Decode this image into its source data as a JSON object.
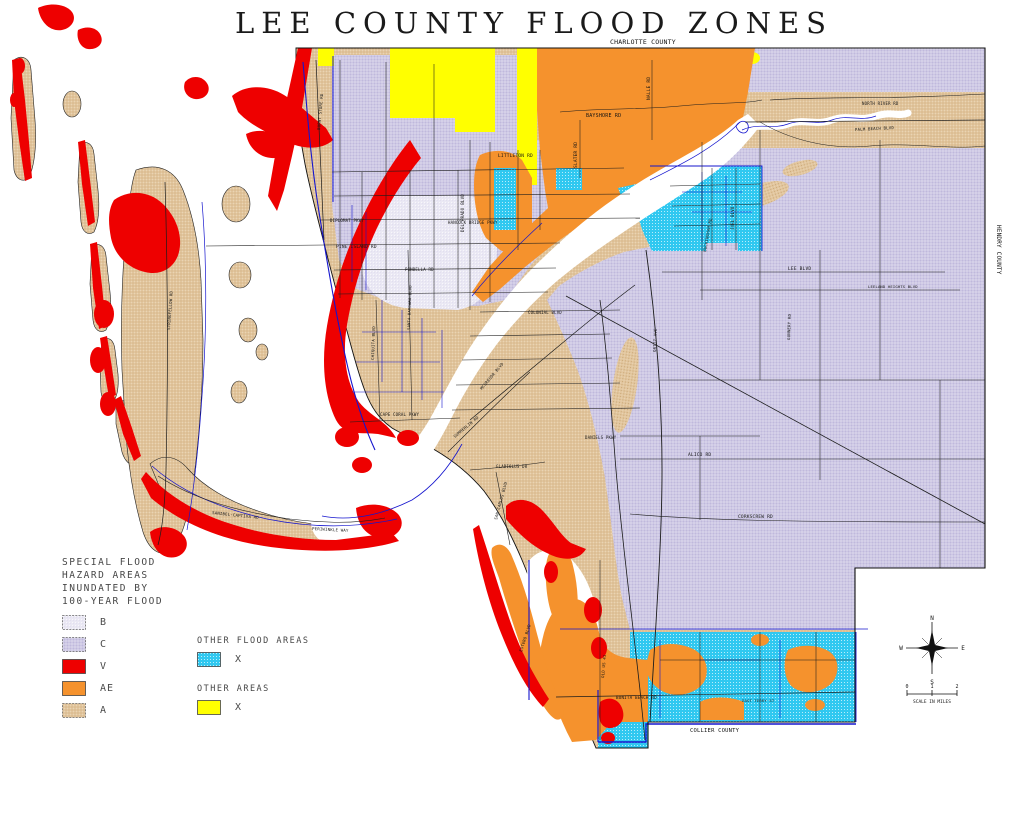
{
  "title": "LEE COUNTY FLOOD ZONES",
  "colors": {
    "zone_b": "#EAE8F4",
    "zone_c": "#CBC6E3",
    "zone_v": "#EE0000",
    "zone_ae": "#F5922D",
    "zone_a": "#E2C69E",
    "zone_x_flood": "#30C8F0",
    "zone_x_other": "#FFFF00",
    "water": "#FFFFFF",
    "canal_blue": "#1515CE",
    "road_black": "#1C1C1C"
  },
  "legend": {
    "title": "SPECIAL FLOOD\nHAZARD AREAS\nINUNDATED BY\n100-YEAR FLOOD",
    "items": [
      {
        "label": "B"
      },
      {
        "label": "C"
      },
      {
        "label": "V"
      },
      {
        "label": "AE"
      },
      {
        "label": "A"
      }
    ],
    "other_flood": {
      "title": "OTHER FLOOD AREAS",
      "item_label": "X"
    },
    "other": {
      "title": "OTHER AREAS",
      "item_label": "X"
    }
  },
  "compass": {
    "n": "N",
    "s": "S",
    "e": "E",
    "w": "W"
  },
  "scale_bar": {
    "ticks": [
      "0",
      "1",
      "2"
    ],
    "label": "SCALE IN MILES"
  },
  "map": {
    "labels": [
      {
        "text": "CHARLOTTE COUNTY",
        "x": 610,
        "y": 44,
        "size": 6.5
      },
      {
        "text": "HENDRY COUNTY",
        "x": 997,
        "y": 225,
        "size": 6,
        "rot": 90
      },
      {
        "text": "COLLIER COUNTY",
        "x": 690,
        "y": 732,
        "size": 5.5
      },
      {
        "text": "BAYSHORE RD",
        "x": 586,
        "y": 117,
        "size": 5
      },
      {
        "text": "SLATER RD",
        "x": 577,
        "y": 168,
        "size": 4.5,
        "rot": -90
      },
      {
        "text": "NALLE RD",
        "x": 650,
        "y": 100,
        "size": 4.5,
        "rot": -90
      },
      {
        "text": "DEL PRADO BLVD",
        "x": 464,
        "y": 232,
        "size": 4.2,
        "rot": -90
      },
      {
        "text": "LITTLETON RD",
        "x": 498,
        "y": 157,
        "size": 4.5
      },
      {
        "text": "HANCOCK BRIDGE PKWY",
        "x": 448,
        "y": 224,
        "size": 4
      },
      {
        "text": "DIPLOMAT PKWY",
        "x": 330,
        "y": 222,
        "size": 4
      },
      {
        "text": "PINE ISLAND RD",
        "x": 336,
        "y": 248,
        "size": 4.5
      },
      {
        "text": "PONDELLA RD",
        "x": 405,
        "y": 271,
        "size": 4
      },
      {
        "text": "COLONIAL BLVD",
        "x": 528,
        "y": 314,
        "size": 4
      },
      {
        "text": "DANIELS PKWY",
        "x": 585,
        "y": 439,
        "size": 4
      },
      {
        "text": "PALM BEACH BLVD",
        "x": 855,
        "y": 131,
        "size": 4,
        "rot": -3
      },
      {
        "text": "NORTH RIVER RD",
        "x": 862,
        "y": 105,
        "size": 4
      },
      {
        "text": "ALICO RD",
        "x": 688,
        "y": 456,
        "size": 4.5
      },
      {
        "text": "CORKSCREW RD",
        "x": 738,
        "y": 518,
        "size": 4.5
      },
      {
        "text": "LEE BLVD",
        "x": 788,
        "y": 270,
        "size": 4.5
      },
      {
        "text": "LEELAND HEIGHTS BLVD",
        "x": 868,
        "y": 288,
        "size": 3.8
      },
      {
        "text": "JOEL BLVD",
        "x": 734,
        "y": 230,
        "size": 4,
        "rot": -90
      },
      {
        "text": "GUNNERY RD",
        "x": 790,
        "y": 340,
        "size": 4,
        "rot": -88
      },
      {
        "text": "BUCKINGHAM RD",
        "x": 706,
        "y": 252,
        "size": 4,
        "rot": -80
      },
      {
        "text": "BONITA BEACH RD",
        "x": 616,
        "y": 699,
        "size": 4.2
      },
      {
        "text": "OLD US 41",
        "x": 604,
        "y": 678,
        "size": 4,
        "rot": -85
      },
      {
        "text": "EAST TERRY ST",
        "x": 742,
        "y": 702,
        "size": 3.8
      },
      {
        "text": "STRINGFELLOW RD",
        "x": 170,
        "y": 330,
        "size": 4,
        "rot": -86
      },
      {
        "text": "SANIBEL-CAPTIVA RD",
        "x": 212,
        "y": 514,
        "size": 4,
        "rot": 6
      },
      {
        "text": "PERIWINKLE WAY",
        "x": 312,
        "y": 530,
        "size": 4,
        "rot": 3
      },
      {
        "text": "MCGREGOR BLVD",
        "x": 482,
        "y": 390,
        "size": 4,
        "rot": -50
      },
      {
        "text": "SUMMERLIN RD",
        "x": 455,
        "y": 438,
        "size": 4,
        "rot": -40
      },
      {
        "text": "GLADIOLUS DR",
        "x": 496,
        "y": 468,
        "size": 4
      },
      {
        "text": "SAN CARLOS BLVD",
        "x": 497,
        "y": 520,
        "size": 4,
        "rot": -75
      },
      {
        "text": "BURNT STORE RD",
        "x": 320,
        "y": 130,
        "size": 4,
        "rot": -85
      },
      {
        "text": "CHIQUITA BLVD",
        "x": 374,
        "y": 360,
        "size": 4,
        "rot": -88
      },
      {
        "text": "SANTA BARBARA BLVD",
        "x": 410,
        "y": 330,
        "size": 3.8,
        "rot": -88
      },
      {
        "text": "CAPE CORAL PKWY",
        "x": 380,
        "y": 416,
        "size": 4
      },
      {
        "text": "ORTIZ AVE",
        "x": 656,
        "y": 352,
        "size": 4,
        "rot": -88
      },
      {
        "text": "ESTERO BLVD",
        "x": 522,
        "y": 652,
        "size": 4,
        "rot": -72
      }
    ]
  }
}
